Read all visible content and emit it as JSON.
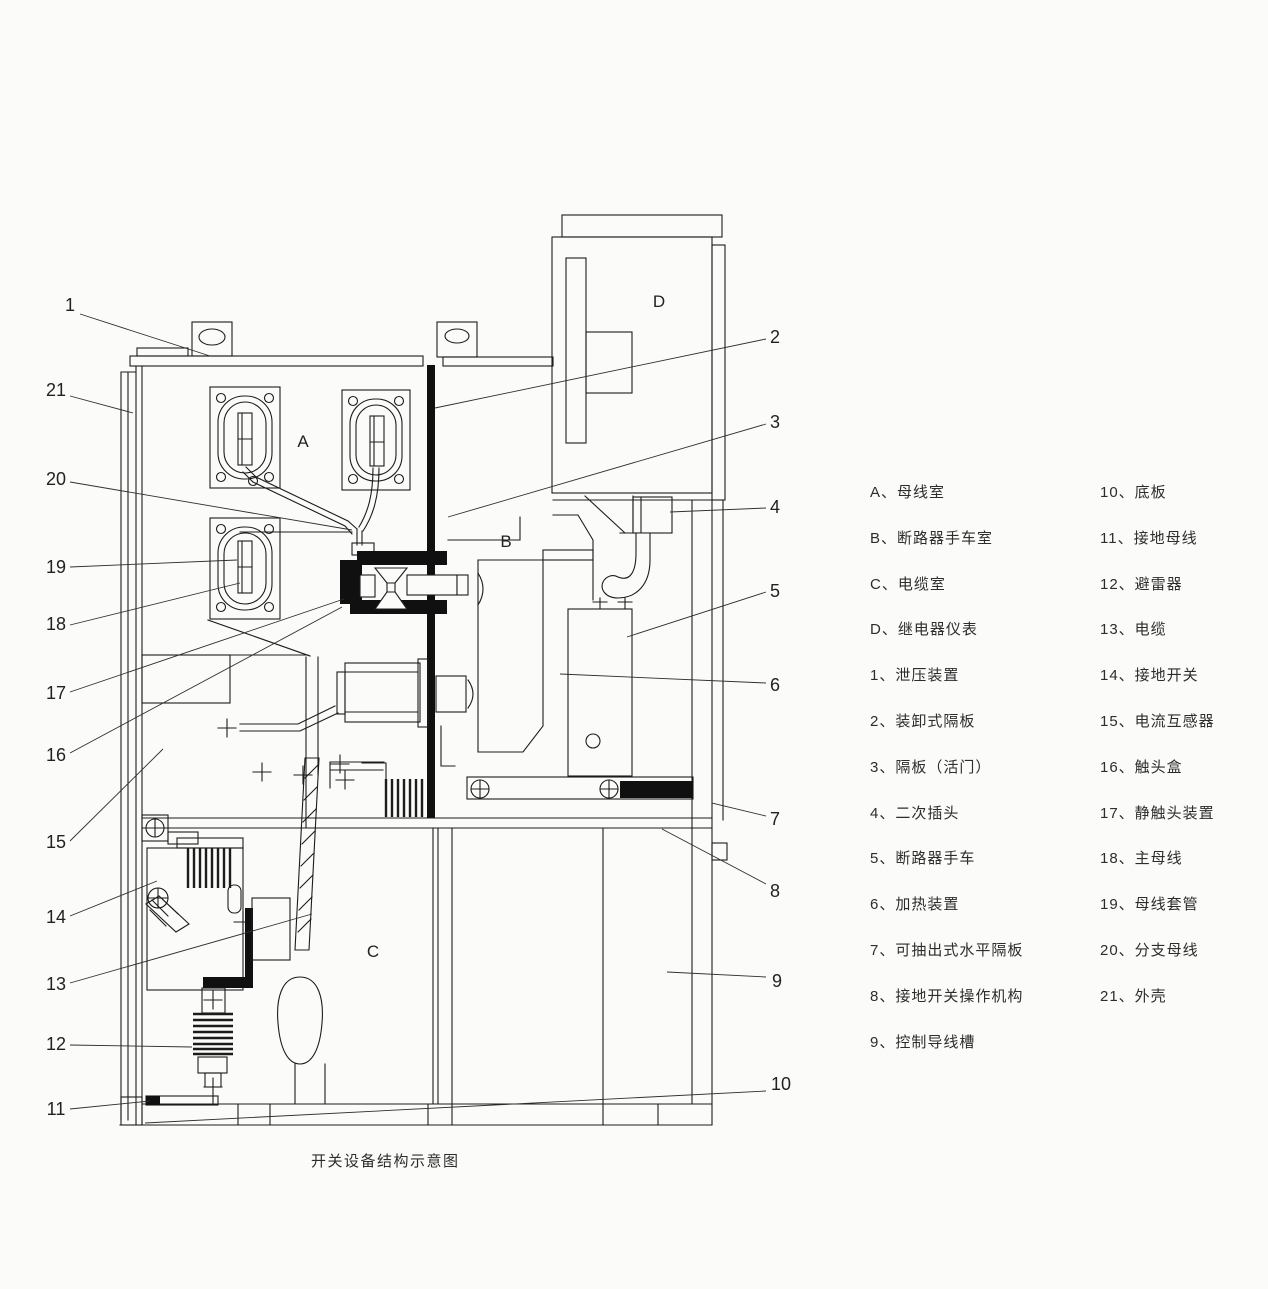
{
  "caption": "开关设备结构示意图",
  "compartment_labels": [
    {
      "id": "A",
      "label": "A",
      "x": 303,
      "y": 447
    },
    {
      "id": "B",
      "label": "B",
      "x": 506,
      "y": 547
    },
    {
      "id": "C",
      "label": "C",
      "x": 373,
      "y": 957
    },
    {
      "id": "D",
      "label": "D",
      "x": 659,
      "y": 307
    }
  ],
  "callouts": [
    {
      "label": "1",
      "tx": 70,
      "ty": 311,
      "line": [
        80,
        314,
        210,
        356
      ]
    },
    {
      "label": "21",
      "tx": 56,
      "ty": 396,
      "line": [
        70,
        396,
        133,
        413
      ]
    },
    {
      "label": "20",
      "tx": 56,
      "ty": 485,
      "line": [
        70,
        482,
        352,
        530
      ]
    },
    {
      "label": "19",
      "tx": 56,
      "ty": 573,
      "line": [
        70,
        567,
        237,
        560
      ]
    },
    {
      "label": "18",
      "tx": 56,
      "ty": 630,
      "line": [
        70,
        625,
        240,
        583
      ]
    },
    {
      "label": "17",
      "tx": 56,
      "ty": 699,
      "line": [
        70,
        692,
        344,
        599
      ]
    },
    {
      "label": "16",
      "tx": 56,
      "ty": 761,
      "line": [
        70,
        753,
        342,
        607
      ]
    },
    {
      "label": "15",
      "tx": 56,
      "ty": 848,
      "line": [
        70,
        841,
        163,
        749
      ]
    },
    {
      "label": "14",
      "tx": 56,
      "ty": 923,
      "line": [
        70,
        916,
        157,
        881
      ]
    },
    {
      "label": "13",
      "tx": 56,
      "ty": 990,
      "line": [
        70,
        983,
        312,
        914
      ]
    },
    {
      "label": "12",
      "tx": 56,
      "ty": 1050,
      "line": [
        70,
        1045,
        192,
        1047
      ]
    },
    {
      "label": "11",
      "tx": 56,
      "ty": 1115,
      "line": [
        70,
        1109,
        150,
        1101
      ]
    },
    {
      "label": "2",
      "tx": 775,
      "ty": 343,
      "line": [
        766,
        339,
        435,
        408
      ]
    },
    {
      "label": "3",
      "tx": 775,
      "ty": 428,
      "line": [
        766,
        424,
        448,
        517
      ]
    },
    {
      "label": "4",
      "tx": 775,
      "ty": 513,
      "line": [
        766,
        508,
        670,
        512
      ]
    },
    {
      "label": "5",
      "tx": 775,
      "ty": 597,
      "line": [
        766,
        592,
        627,
        637
      ]
    },
    {
      "label": "6",
      "tx": 775,
      "ty": 691,
      "line": [
        766,
        683,
        560,
        674
      ]
    },
    {
      "label": "7",
      "tx": 775,
      "ty": 825,
      "line": [
        766,
        816,
        712,
        803
      ]
    },
    {
      "label": "8",
      "tx": 775,
      "ty": 897,
      "line": [
        766,
        884,
        662,
        829
      ]
    },
    {
      "label": "9",
      "tx": 777,
      "ty": 987,
      "line": [
        766,
        977,
        667,
        972
      ]
    },
    {
      "label": "10",
      "tx": 781,
      "ty": 1090,
      "line": [
        766,
        1091,
        145,
        1123
      ]
    }
  ],
  "legend": {
    "left": [
      "A、母线室",
      "B、断路器手车室",
      "C、电缆室",
      "D、继电器仪表",
      "1、泄压装置",
      "2、装卸式隔板",
      "3、隔板（活门）",
      "4、二次插头",
      "5、断路器手车",
      "6、加热装置",
      "7、可抽出式水平隔板",
      "8、接地开关操作机构",
      "9、控制导线槽"
    ],
    "right": [
      "10、底板",
      "11、接地母线",
      "12、避雷器",
      "13、电缆",
      "14、接地开关",
      "15、电流互感器",
      "16、触头盒",
      "17、静触头装置",
      "18、主母线",
      "19、母线套管",
      "20、分支母线",
      "21、外壳"
    ]
  }
}
